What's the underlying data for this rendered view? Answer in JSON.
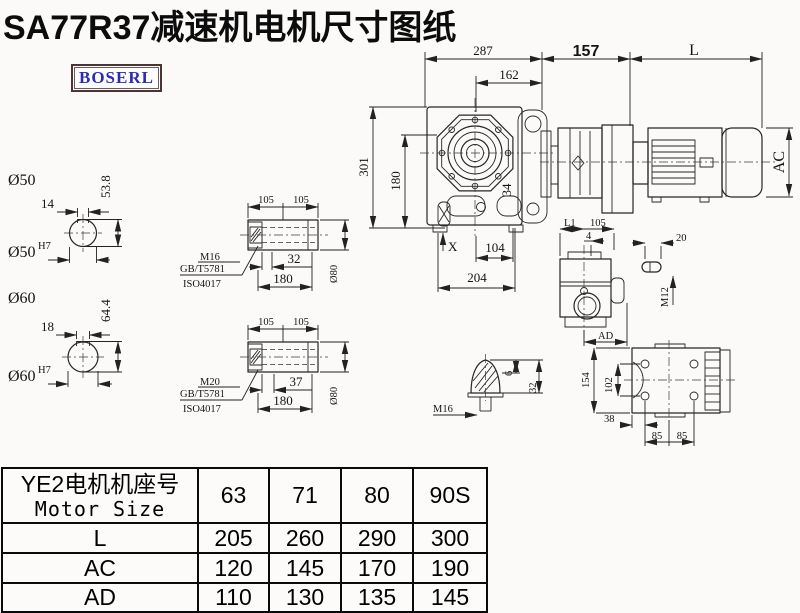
{
  "title": "SA77R37减速机电机尺寸图纸",
  "brand": "BOSERL",
  "main_view": {
    "overall_width": "287",
    "flange_offset": "162",
    "adapter_length": "157",
    "motor_length": "L",
    "motor_height": "AC",
    "total_height": "301",
    "axis_height": "180",
    "side_dim": "34",
    "oil_plug_mark": "X",
    "base_center": "104",
    "base_width": "204"
  },
  "shaft_top": {
    "diameter": "Ø50",
    "key_width": "14",
    "key_height": "53.8",
    "bore": "Ø50",
    "bore_tol": "H7"
  },
  "shaft_bottom": {
    "diameter": "Ø60",
    "key_width": "18",
    "key_height": "64.4",
    "bore": "Ø60",
    "bore_tol": "H7"
  },
  "hollow_top": {
    "seg_a": "105",
    "seg_b": "105",
    "bolt": "M16",
    "std1": "GB/T5781",
    "std2": "ISO4017",
    "bolt_len": "32",
    "total_len": "180",
    "outer_dia": "Ø80"
  },
  "hollow_bottom": {
    "seg_a": "105",
    "seg_b": "105",
    "bolt": "M20",
    "std1": "GB/T5781",
    "std2": "ISO4017",
    "bolt_len": "37",
    "total_len": "180",
    "outer_dia": "Ø80"
  },
  "side_view": {
    "dim_l1": "L1",
    "dim_top": "105",
    "dim_small": "4",
    "dim_ad": "AD"
  },
  "key_view": {
    "length": "20",
    "thread": "M12"
  },
  "plug_view": {
    "thread": "M16",
    "tip_len": "6",
    "height": "32"
  },
  "rear_view": {
    "height": "154",
    "hole_span_v": "102",
    "edge_offset": "38",
    "hole_span_a": "85",
    "hole_span_b": "85"
  },
  "table": {
    "header_cn": "YE2电机机座号",
    "header_en": "Motor Size",
    "columns": [
      "63",
      "71",
      "80",
      "90S"
    ],
    "rows": [
      {
        "label": "L",
        "values": [
          "205",
          "260",
          "290",
          "300"
        ]
      },
      {
        "label": "AC",
        "values": [
          "120",
          "145",
          "170",
          "190"
        ]
      },
      {
        "label": "AD",
        "values": [
          "110",
          "130",
          "135",
          "145"
        ]
      }
    ]
  }
}
